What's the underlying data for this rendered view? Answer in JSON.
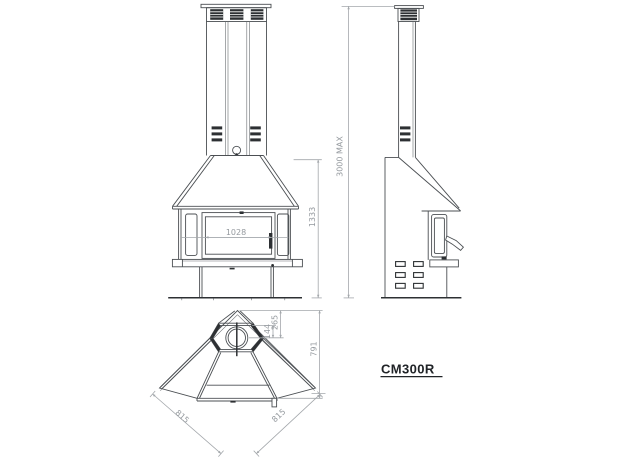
{
  "model_label": "CM300R",
  "front_view": {
    "glass_width": "1028",
    "overall_height": "1333"
  },
  "side_view": {
    "max_flue_height": "3000 MAX"
  },
  "plan_view": {
    "flue_center_to_box": "144",
    "flue_center_to_corner": "265",
    "depth": "791",
    "left_side": "815",
    "right_side": "815"
  },
  "colors": {
    "drawing_line": "#4b4f53",
    "dark_detail": "#2d3033",
    "dimension_line": "#a3a7ab",
    "dimension_text": "#94999e",
    "model_text": "#202327",
    "background": "#ffffff"
  }
}
